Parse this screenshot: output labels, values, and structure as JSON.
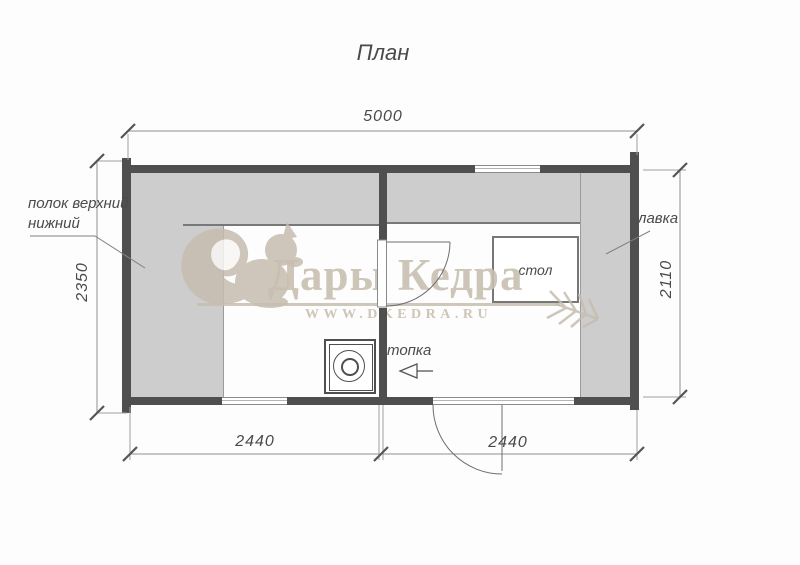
{
  "title": "План",
  "watermark": {
    "brand": "Дары Кедра",
    "url": "WWW.DKEDRA.RU",
    "color": "#c8bfb1"
  },
  "dimensions": {
    "top_width": "5000",
    "left_height": "2350",
    "right_height": "2110",
    "bottom_left_width": "2440",
    "bottom_right_width": "2440"
  },
  "labels": {
    "shelf_upper": "полок верхний",
    "shelf_lower": "нижний",
    "bench": "лавка",
    "table": "стол",
    "stove": "топка"
  },
  "colors": {
    "wall": "#4f4f4f",
    "bench": "#cdcdcd",
    "dimension_line": "#999999",
    "tick": "#555555",
    "label_text": "#4a4a4a",
    "watermark": "#c8bfb1"
  }
}
